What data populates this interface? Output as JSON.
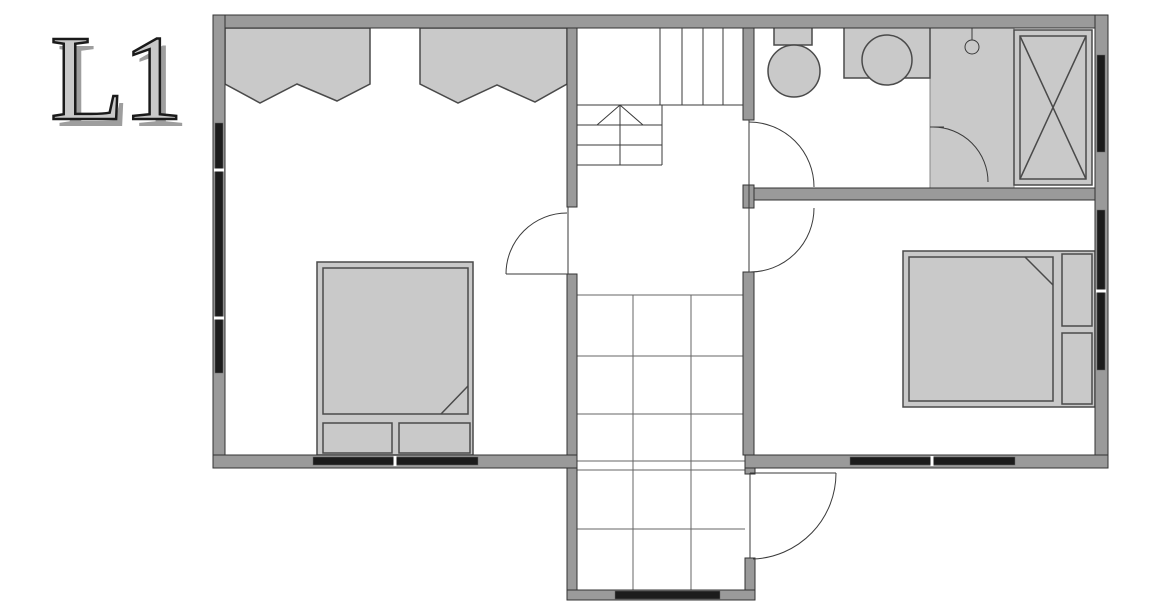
{
  "plan": {
    "label": "L1",
    "fixtures": [
      "hanging-wardrobe-left",
      "hanging-wardrobe-middle",
      "double-bed-left",
      "double-bed-right",
      "toilet",
      "washbasin-counter",
      "shower-area",
      "shower-head",
      "tall-cabinet-x",
      "staircase-up",
      "tiled-entry-floor"
    ],
    "door_count": "5",
    "window_count": "6"
  },
  "colors": {
    "wall_fill": "#9a9a9a",
    "wall_stroke": "#333333",
    "furniture_fill": "#c9c9c9",
    "furniture_stroke": "#4a4a4a",
    "window_band": "#1c1c1c",
    "line": "#3a3a3a",
    "grid_line": "#666666",
    "label_fill": "#c9c9c9",
    "label_outline": "#1a1a1a",
    "label_shadow": "#9e9e9e",
    "floor": "#ffffff"
  }
}
